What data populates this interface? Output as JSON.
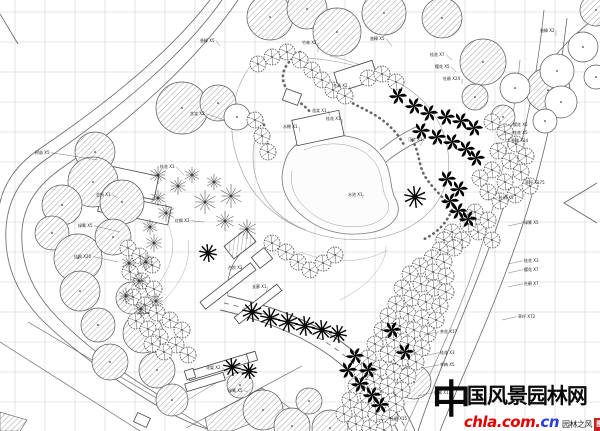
{
  "watermark": {
    "char_first": "中",
    "title_rest": "国风景园林网",
    "url_main": "chla.com.",
    "url_suffix": "cn",
    "tagline": "园林之风",
    "seal_char": "图",
    "colors": {
      "title": "#0a0a0a",
      "url_main": "#e30000",
      "url_suffix": "#2a3fd4",
      "seal": "#c22222",
      "tagline": "#222222"
    }
  },
  "plan": {
    "canvas": {
      "w": 600,
      "h": 431,
      "bg": "#ffffff"
    },
    "grid": {
      "spacing": 30,
      "offset_x": 15,
      "offset_y": 12,
      "color": "#c9c9c9",
      "stroke_width": 0.5
    },
    "line_color": "#666666",
    "tree_color": "#444444",
    "roads": [
      {
        "d": "M222,0 C180,60 110,115 45,160 C20,178 8,200 6,228 C4,260 14,290 40,318 C70,348 120,385 168,412 C185,421 202,428 215,431",
        "w": 0.8
      },
      {
        "d": "M238,0 C196,62 128,122 62,168 C36,186 24,206 22,230 C20,262 32,292 58,318 C88,348 132,381 178,406",
        "w": 0.8
      },
      {
        "d": "M210,0 C168,55 100,108 38,150 C12,168 0,190 -2,215",
        "w": 0.8
      },
      {
        "d": "M0,14 L18,44",
        "w": 0.8
      },
      {
        "d": "M544,10 C536,90 518,170 492,240 C466,312 436,375 418,431",
        "w": 0.8
      },
      {
        "d": "M567,18 C558,98 540,178 514,250 C488,322 458,385 440,431",
        "w": 0.8
      },
      {
        "d": "M600,14 C574,34 556,52 544,72",
        "w": 0.8
      },
      {
        "d": "M597,183 L564,203 L597,223",
        "w": 0.9
      },
      {
        "d": "M520,60 C512,140 494,215 468,285 C446,343 420,395 404,431",
        "w": 0.7,
        "c": "#888888"
      },
      {
        "d": "M228,296 C272,306 318,322 352,350 C382,375 402,400 415,431",
        "w": 0.9
      },
      {
        "d": "M220,310 C264,320 306,336 338,362 C366,386 386,408 398,431",
        "w": 0.9
      },
      {
        "d": "M224,303 C268,313 312,329 345,356 C374,381 394,404 407,431",
        "w": 0.8,
        "dash": "5 5"
      },
      {
        "d": "M228,296 C226,280 230,264 242,252",
        "w": 0.7
      },
      {
        "d": "M252,64 C230,92 226,132 240,166 C250,194 272,216 302,229 C342,245 386,243 416,223 C441,206 452,180 448,152 C444,120 424,96 394,80 C358,62 296,50 252,64",
        "w": 0.6,
        "c": "#999999"
      },
      {
        "d": "M380,150 C392,140 404,132 418,126",
        "w": 0.7
      },
      {
        "d": "M386,162 C398,152 412,144 426,138",
        "w": 0.7
      },
      {
        "d": "M135,306 C162,286 176,262 172,238 C169,220 158,210 150,197",
        "w": 0.5,
        "c": "#aaaaaa"
      },
      {
        "d": "M150,312 C177,292 192,266 188,240",
        "w": 0.5,
        "c": "#aaaaaa"
      },
      {
        "d": "M300,252 C332,264 362,264 388,250",
        "w": 0.5,
        "c": "#aaaaaa"
      },
      {
        "d": "M340,300 C368,286 386,266 386,246",
        "w": 0.5,
        "c": "#aaaaaa"
      },
      {
        "d": "M0,342 L140,431",
        "w": 0.7
      },
      {
        "d": "M28,322 L212,431",
        "w": 0.7
      },
      {
        "d": "M186,428 L302,366",
        "w": 0.7
      },
      {
        "d": "M178,406 C200,392 220,380 238,372",
        "w": 0.6,
        "c": "#999999"
      },
      {
        "d": "M262,120 C252,140 250,162 258,184 C266,206 284,222 306,230",
        "w": 0.6,
        "c": "#999999"
      },
      {
        "d": "M330,56 C356,62 382,72 402,88",
        "w": 0.6,
        "c": "#999999"
      }
    ],
    "pond": {
      "d": "M300,142 C330,130 362,134 378,152 C394,168 388,186 396,200 C404,216 390,230 368,233 C342,237 320,230 305,218 C288,205 279,188 283,169 C286,154 291,148 300,142 Z",
      "fill": "#fcfcfc",
      "stroke": "#777777",
      "w": 0.8
    },
    "pond_shore": {
      "d": "M304,150 C328,140 356,142 371,158 C385,172 380,188 387,200 C393,212 382,223 364,226 C342,229 323,223 310,212 C296,201 289,187 292,171",
      "w": 0.5,
      "c": "#999999"
    },
    "stones": [
      {
        "d": "M300,52 C286,62 279,74 285,86 C291,98 303,103 311,113"
      },
      {
        "d": "M340,96 C352,104 366,109 378,117 C390,125 398,134 404,145"
      },
      {
        "d": "M412,140 C420,152 418,166 426,178 C434,190 444,197 450,208"
      },
      {
        "d": "M452,210 C446,224 436,234 422,240"
      },
      {
        "d": "M262,120 C268,132 266,146 272,158"
      }
    ],
    "hatch_areas": [
      {
        "d": "M205,418 L262,388 L290,408 L232,431 L208,431 Z"
      },
      {
        "d": "M0,412 L27,420 L20,431 L0,431 Z"
      }
    ],
    "buildings": [
      [
        356,
        76,
        40,
        20,
        -18,
        0
      ],
      [
        318,
        128,
        48,
        26,
        -12,
        0
      ],
      [
        292,
        97,
        16,
        12,
        20,
        0
      ],
      [
        128,
        182,
        58,
        24,
        12,
        0
      ],
      [
        150,
        212,
        40,
        18,
        12,
        0
      ],
      [
        111,
        206,
        24,
        16,
        12,
        0
      ],
      [
        228,
        286,
        64,
        9,
        -38,
        0
      ],
      [
        258,
        304,
        54,
        8,
        -38,
        0
      ],
      [
        262,
        258,
        16,
        14,
        -38,
        0
      ],
      [
        240,
        244,
        28,
        16,
        -38,
        1
      ],
      [
        222,
        366,
        70,
        9,
        -17,
        0
      ],
      [
        205,
        382,
        40,
        8,
        -17,
        0
      ],
      [
        190,
        374,
        9,
        9,
        -17,
        0
      ],
      [
        252,
        357,
        9,
        9,
        -17,
        0
      ],
      [
        142,
        420,
        14,
        10,
        25,
        0
      ]
    ],
    "hatch_trees": [
      [
        270,
        17,
        23
      ],
      [
        307,
        9,
        20
      ],
      [
        337,
        32,
        24
      ],
      [
        384,
        13,
        22
      ],
      [
        442,
        18,
        20
      ],
      [
        483,
        62,
        23
      ],
      [
        548,
        90,
        22
      ],
      [
        475,
        97,
        13
      ],
      [
        503,
        117,
        12
      ],
      [
        596,
        10,
        16
      ],
      [
        182,
        108,
        26
      ],
      [
        218,
        103,
        18
      ],
      [
        95,
        152,
        20
      ],
      [
        93,
        182,
        25
      ],
      [
        122,
        202,
        22
      ],
      [
        62,
        205,
        20
      ],
      [
        52,
        233,
        17
      ],
      [
        78,
        258,
        24
      ],
      [
        80,
        291,
        20
      ],
      [
        113,
        237,
        18
      ],
      [
        98,
        325,
        17
      ],
      [
        110,
        362,
        18
      ],
      [
        143,
        333,
        20
      ],
      [
        157,
        370,
        18
      ],
      [
        172,
        400,
        16
      ],
      [
        132,
        298,
        16
      ],
      [
        263,
        410,
        20
      ],
      [
        292,
        426,
        18
      ],
      [
        330,
        428,
        18
      ],
      [
        309,
        401,
        13
      ],
      [
        398,
        346,
        18
      ],
      [
        414,
        382,
        17
      ],
      [
        240,
        385,
        13
      ]
    ],
    "outline_trees": [
      [
        515,
        88,
        15
      ],
      [
        557,
        71,
        17
      ],
      [
        561,
        102,
        16
      ],
      [
        545,
        121,
        12
      ],
      [
        583,
        47,
        15
      ],
      [
        596,
        77,
        12
      ],
      [
        237,
        117,
        13
      ]
    ],
    "flower_trees": [
      [
        258,
        64
      ],
      [
        272,
        57
      ],
      [
        287,
        52
      ],
      [
        300,
        60
      ],
      [
        312,
        70
      ],
      [
        322,
        80
      ],
      [
        333,
        90
      ],
      [
        345,
        96
      ],
      [
        255,
        120
      ],
      [
        262,
        136
      ],
      [
        268,
        152
      ],
      [
        368,
        78
      ],
      [
        382,
        74
      ],
      [
        396,
        82
      ],
      [
        272,
        243
      ],
      [
        286,
        252
      ],
      [
        298,
        262
      ],
      [
        310,
        270
      ],
      [
        323,
        263
      ],
      [
        335,
        255
      ],
      [
        492,
        122
      ],
      [
        505,
        132
      ],
      [
        516,
        144
      ],
      [
        498,
        151
      ],
      [
        510,
        161
      ],
      [
        521,
        172
      ],
      [
        505,
        182
      ],
      [
        492,
        170
      ],
      [
        480,
        178
      ],
      [
        515,
        195
      ],
      [
        500,
        201
      ],
      [
        526,
        156
      ],
      [
        530,
        186
      ],
      [
        488,
        192
      ],
      [
        475,
        212
      ],
      [
        488,
        220
      ],
      [
        478,
        232
      ],
      [
        492,
        240
      ],
      [
        468,
        224
      ],
      [
        128,
        248
      ],
      [
        140,
        256
      ],
      [
        152,
        265
      ],
      [
        130,
        272
      ],
      [
        142,
        281
      ],
      [
        154,
        289
      ],
      [
        133,
        297
      ],
      [
        145,
        305
      ],
      [
        157,
        313
      ],
      [
        136,
        321
      ],
      [
        148,
        329
      ],
      [
        160,
        337
      ],
      [
        170,
        320
      ],
      [
        182,
        330
      ],
      [
        176,
        345
      ],
      [
        188,
        355
      ],
      [
        164,
        352
      ],
      [
        152,
        344
      ],
      [
        452,
        232
      ],
      [
        462,
        240
      ],
      [
        444,
        240
      ],
      [
        454,
        248
      ],
      [
        440,
        250
      ],
      [
        432,
        258
      ],
      [
        444,
        262
      ],
      [
        420,
        266
      ],
      [
        433,
        272
      ],
      [
        446,
        276
      ],
      [
        410,
        274
      ],
      [
        421,
        284
      ],
      [
        434,
        288
      ],
      [
        446,
        292
      ],
      [
        402,
        288
      ],
      [
        412,
        298
      ],
      [
        426,
        302
      ],
      [
        440,
        306
      ],
      [
        396,
        304
      ],
      [
        408,
        314
      ],
      [
        422,
        318
      ],
      [
        436,
        320
      ],
      [
        388,
        316
      ],
      [
        400,
        326
      ],
      [
        414,
        330
      ],
      [
        428,
        334
      ],
      [
        382,
        330
      ],
      [
        394,
        340
      ],
      [
        408,
        344
      ],
      [
        422,
        348
      ],
      [
        375,
        344
      ],
      [
        388,
        354
      ],
      [
        402,
        358
      ],
      [
        416,
        362
      ],
      [
        368,
        358
      ],
      [
        380,
        368
      ],
      [
        394,
        372
      ],
      [
        408,
        376
      ],
      [
        362,
        372
      ],
      [
        374,
        382
      ],
      [
        388,
        386
      ],
      [
        402,
        390
      ],
      [
        356,
        386
      ],
      [
        368,
        396
      ],
      [
        382,
        400
      ],
      [
        396,
        404
      ],
      [
        350,
        400
      ],
      [
        362,
        410
      ],
      [
        376,
        414
      ],
      [
        390,
        418
      ],
      [
        344,
        414
      ],
      [
        356,
        424
      ],
      [
        370,
        428
      ],
      [
        384,
        430
      ]
    ],
    "spoke_trees": [
      [
        158,
        175,
        9
      ],
      [
        178,
        186,
        9
      ],
      [
        158,
        198,
        8
      ],
      [
        166,
        213,
        9
      ],
      [
        150,
        227,
        8
      ],
      [
        154,
        243,
        9
      ],
      [
        146,
        262,
        9
      ],
      [
        129,
        263,
        8
      ],
      [
        139,
        281,
        9
      ],
      [
        126,
        296,
        8
      ],
      [
        141,
        309,
        9
      ],
      [
        156,
        301,
        8
      ],
      [
        205,
        202,
        12
      ],
      [
        231,
        196,
        12
      ],
      [
        225,
        221,
        10
      ],
      [
        247,
        229,
        10
      ],
      [
        192,
        175,
        8
      ],
      [
        214,
        182,
        8
      ]
    ],
    "dark_spoke_trees": [
      [
        252,
        312,
        10
      ],
      [
        270,
        318,
        10
      ],
      [
        288,
        322,
        10
      ],
      [
        305,
        326,
        10
      ],
      [
        322,
        330,
        10
      ],
      [
        338,
        334,
        9
      ],
      [
        232,
        367,
        9
      ],
      [
        249,
        371,
        8
      ],
      [
        415,
        197,
        11
      ],
      [
        208,
        253,
        9
      ]
    ],
    "pinwheels": [
      [
        398,
        96
      ],
      [
        414,
        106
      ],
      [
        429,
        113
      ],
      [
        446,
        117
      ],
      [
        461,
        121
      ],
      [
        474,
        128
      ],
      [
        421,
        131
      ],
      [
        437,
        137
      ],
      [
        452,
        142
      ],
      [
        466,
        149
      ],
      [
        476,
        158
      ],
      [
        447,
        179
      ],
      [
        459,
        189
      ],
      [
        450,
        201
      ],
      [
        458,
        211
      ],
      [
        468,
        219
      ],
      [
        355,
        356
      ],
      [
        368,
        370
      ],
      [
        360,
        384
      ],
      [
        372,
        395
      ],
      [
        348,
        370
      ],
      [
        392,
        330
      ],
      [
        405,
        352
      ],
      [
        380,
        405
      ]
    ],
    "labels": [
      [
        35,
        154,
        "树苗 X5",
        98,
        160
      ],
      [
        78,
        227,
        "绿篱 X5",
        120,
        232
      ],
      [
        74,
        258,
        "红枫 X20",
        118,
        262
      ],
      [
        96,
        196,
        "会所 X1",
        118,
        198
      ],
      [
        190,
        115,
        "含笑 X2",
        224,
        120
      ],
      [
        160,
        168,
        "桂花 X3",
        184,
        175
      ],
      [
        175,
        222,
        "红枫 X3",
        204,
        222
      ],
      [
        200,
        42,
        "香樟 X5",
        220,
        46
      ],
      [
        302,
        44,
        "竹林 X2",
        318,
        52
      ],
      [
        333,
        87,
        "冬青 X2",
        352,
        92
      ],
      [
        312,
        112,
        "含笑 X1",
        330,
        116
      ],
      [
        326,
        120,
        "桂花 X1",
        342,
        124
      ],
      [
        283,
        128,
        "水榭 X1",
        300,
        132
      ],
      [
        370,
        40,
        "香樟 X5",
        392,
        46
      ],
      [
        430,
        56,
        "桂花 X7",
        452,
        60
      ],
      [
        435,
        68,
        "樱花 X5",
        456,
        72
      ],
      [
        443,
        80,
        "杜鹃 X24",
        462,
        84
      ],
      [
        540,
        32,
        "香樟 X2",
        556,
        36
      ],
      [
        513,
        126,
        "樱花 X5",
        498,
        128
      ],
      [
        513,
        134,
        "桂花 X5",
        498,
        136
      ],
      [
        511,
        142,
        "垂柳 X14",
        496,
        144
      ],
      [
        525,
        184,
        "草坪 X175",
        516,
        188
      ],
      [
        499,
        199,
        "杜鹃 X5",
        486,
        200
      ],
      [
        524,
        224,
        "绿篱 X5",
        508,
        226
      ],
      [
        524,
        262,
        "桂花 X3",
        508,
        264
      ],
      [
        524,
        271,
        "樱花 X7",
        508,
        273
      ],
      [
        524,
        285,
        "杜鹃 X7",
        508,
        287
      ],
      [
        518,
        318,
        "草坪 X72",
        502,
        320
      ],
      [
        440,
        333,
        "茶花 X17",
        424,
        335
      ],
      [
        440,
        354,
        "桂花 X3",
        424,
        356
      ],
      [
        440,
        366,
        "茶梅 X5",
        424,
        368
      ],
      [
        434,
        394,
        "绿篱 X13",
        418,
        396
      ],
      [
        390,
        420,
        "杜鹃 X15",
        376,
        420
      ],
      [
        206,
        369,
        "花架 X2",
        228,
        372
      ],
      [
        228,
        392,
        "绿篱 X5",
        248,
        392
      ],
      [
        252,
        288,
        "长廊 X1",
        266,
        292
      ],
      [
        228,
        269,
        "台阶 X2",
        240,
        272
      ],
      [
        408,
        141,
        "汀步 X1",
        420,
        146
      ],
      [
        348,
        196,
        "水池 X1",
        362,
        198
      ]
    ]
  }
}
